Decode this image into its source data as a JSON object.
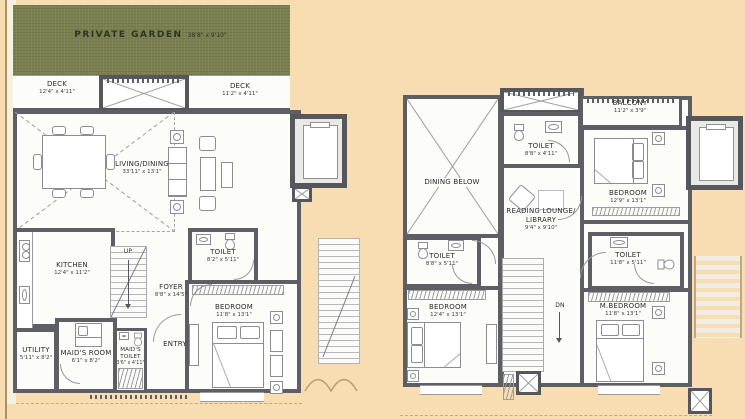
{
  "palette": {
    "background": "#f8dcb2",
    "garden": "#7a8050",
    "wall": "#5d5f64",
    "floor": "#fcfcf9"
  },
  "left": {
    "garden": {
      "label": "PRIVATE GARDEN",
      "dim": "38'8\" x 9'10\""
    },
    "deck_left": {
      "label": "DECK",
      "dim": "12'4\" x 4'11\""
    },
    "deck_right": {
      "label": "DECK",
      "dim": "11'2\" x 4'11\""
    },
    "living": {
      "label": "LIVING/DINING",
      "dim": "33'11\" x 13'1\""
    },
    "kitchen": {
      "label": "KITCHEN",
      "dim": "12'4\" x 11'2\""
    },
    "utility": {
      "label": "UTILITY",
      "dim": "5'11\" x 8'2\""
    },
    "maids_room": {
      "label": "MAID'S ROOM",
      "dim": "6'1\" x 8'2\""
    },
    "maids_toilet": {
      "label": "MAID'S TOILET",
      "dim": "3'6\" x 4'11\""
    },
    "foyer": {
      "label": "FOYER",
      "dim": "8'8\" x 14'5\""
    },
    "entry": {
      "label": "ENTRY"
    },
    "up": {
      "label": "UP"
    },
    "toilet": {
      "label": "TOILET",
      "dim": "8'2\" x 5'11\""
    },
    "bedroom": {
      "label": "BEDROOM",
      "dim": "11'8\" x 13'1\""
    }
  },
  "right": {
    "balcony": {
      "label": "BALCONY",
      "dim": "11'2\" x 3'9\""
    },
    "dining_below": {
      "label": "DINING BELOW"
    },
    "toilet_top": {
      "label": "TOILET",
      "dim": "8'8\" x 4'11\""
    },
    "reading": {
      "label": "READING LOUNGE/ LIBRARY",
      "dim": "9'4\" x 9'10\""
    },
    "bedroom_top": {
      "label": "BEDROOM",
      "dim": "12'9\" x 13'1\""
    },
    "toilet_left": {
      "label": "TOILET",
      "dim": "8'8\" x 5'11\""
    },
    "bedroom_left": {
      "label": "BEDROOM",
      "dim": "12'4\" x 13'1\""
    },
    "dn": {
      "label": "DN"
    },
    "toilet_right": {
      "label": "TOILET",
      "dim": "11'8\" x 5'11\""
    },
    "m_bedroom": {
      "label": "M.BEDROOM",
      "dim": "11'8\" x 13'1\""
    }
  }
}
